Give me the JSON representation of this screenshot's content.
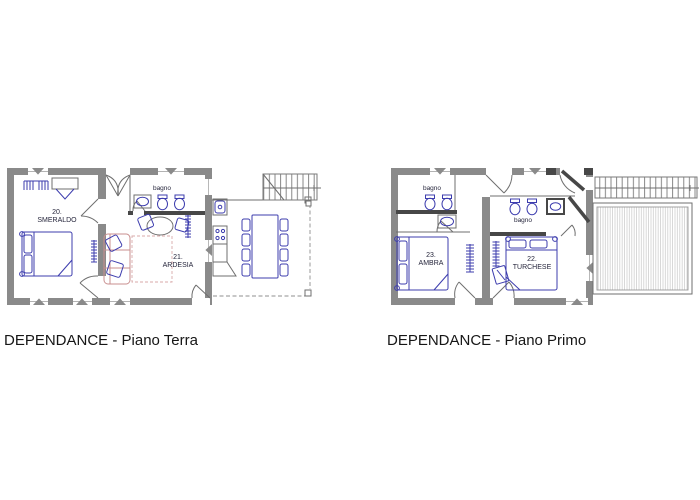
{
  "drawing": {
    "type": "architectural floor plan",
    "colors": {
      "wall": "#8a8a8a",
      "dark_wall": "#474747",
      "furniture_blue": "#3d3dae",
      "sofa_pink": "#c98f8f",
      "terrace_hatch": "#c9c9c9",
      "text": "#161616"
    }
  },
  "plans": [
    {
      "id": "piano-terra",
      "caption": "DEPENDANCE - Piano Terra",
      "rooms": [
        {
          "number": "20.",
          "name": "SMERALDO"
        },
        {
          "number": "21.",
          "name": "ARDESIA"
        }
      ],
      "bathroom_label": "bagno"
    },
    {
      "id": "piano-primo",
      "caption": "DEPENDANCE - Piano Primo",
      "rooms": [
        {
          "number": "23.",
          "name": "AMBRA"
        },
        {
          "number": "22.",
          "name": "TURCHESE"
        }
      ],
      "bathroom_labels": [
        "bagno",
        "bagno"
      ]
    }
  ]
}
